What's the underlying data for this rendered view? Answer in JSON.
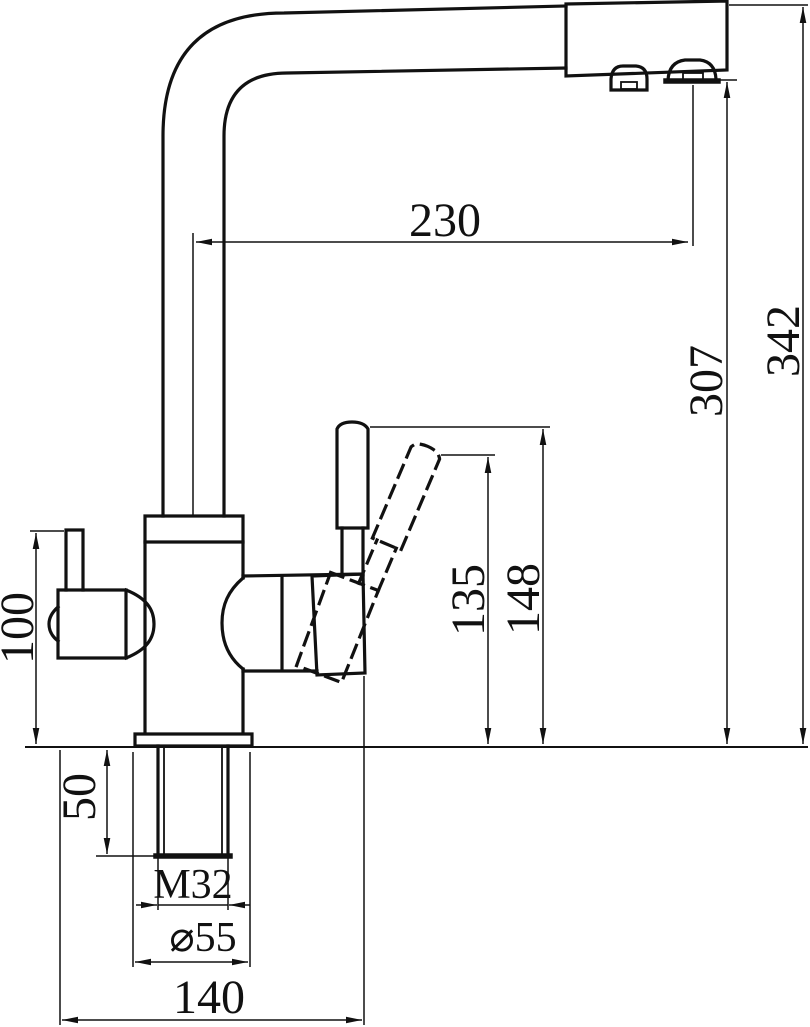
{
  "drawing": {
    "background_color": "#ffffff",
    "line_color": "#111111",
    "style": "CAD line drawing, side elevation of a two-channel kitchen faucet with dimension callouts",
    "dimensions": [
      {
        "id": "spout-reach",
        "label": "230",
        "value": 230,
        "axis": "horizontal",
        "rotated_text": false
      },
      {
        "id": "overall-height",
        "label": "342",
        "value": 342,
        "axis": "vertical",
        "rotated_text": true
      },
      {
        "id": "spout-outlet-height",
        "label": "307",
        "value": 307,
        "axis": "vertical",
        "rotated_text": true
      },
      {
        "id": "handle-top-height",
        "label": "148",
        "value": 148,
        "axis": "vertical",
        "rotated_text": true
      },
      {
        "id": "handle-tilted-height",
        "label": "135",
        "value": 135,
        "axis": "vertical",
        "rotated_text": true
      },
      {
        "id": "side-outlet-height",
        "label": "100",
        "value": 100,
        "axis": "vertical",
        "rotated_text": true
      },
      {
        "id": "shank-length",
        "label": "50",
        "value": 50,
        "axis": "vertical",
        "rotated_text": true
      },
      {
        "id": "thread-spec",
        "label": "M32",
        "value": "M32",
        "axis": "horizontal",
        "rotated_text": false
      },
      {
        "id": "base-diameter",
        "label": "⌀55",
        "value": 55,
        "axis": "horizontal",
        "rotated_text": false
      },
      {
        "id": "base-span",
        "label": "140",
        "value": 140,
        "axis": "horizontal",
        "rotated_text": false
      }
    ]
  }
}
